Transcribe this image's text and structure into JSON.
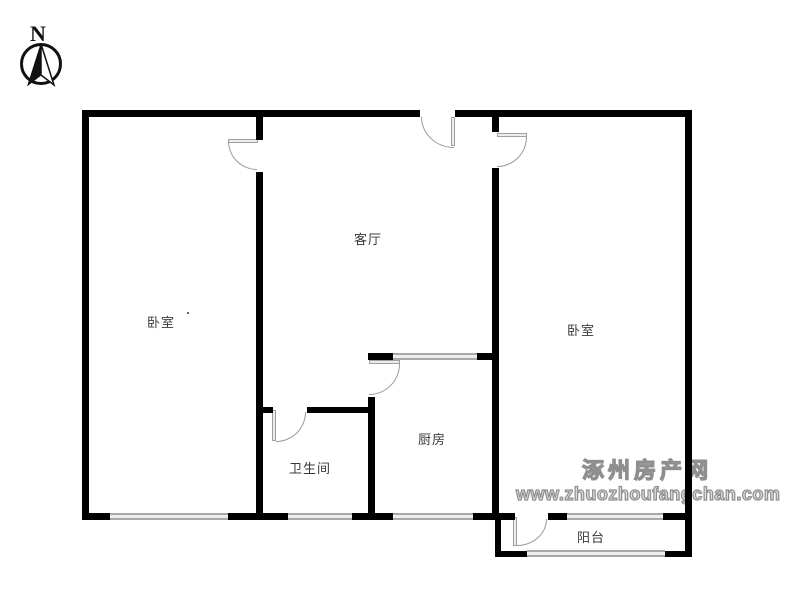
{
  "compass": {
    "label": "N"
  },
  "rooms": {
    "bedroom_left": {
      "label": "卧室"
    },
    "living_room": {
      "label": "客厅"
    },
    "bedroom_right": {
      "label": "卧室"
    },
    "bathroom": {
      "label": "卫生间"
    },
    "kitchen": {
      "label": "厨房"
    },
    "balcony": {
      "label": "阳台"
    }
  },
  "watermark": {
    "site_name": "涿州房产网",
    "site_url": "www.zhuozhoufangchan.com"
  },
  "colors": {
    "wall": "#000000",
    "door_arc": "#9a9a9a",
    "window_fill": "#ededed",
    "window_edge": "#a8a8a8",
    "label_text": "#3a3a3a",
    "watermark": "#8f8f8f",
    "background": "#ffffff"
  }
}
